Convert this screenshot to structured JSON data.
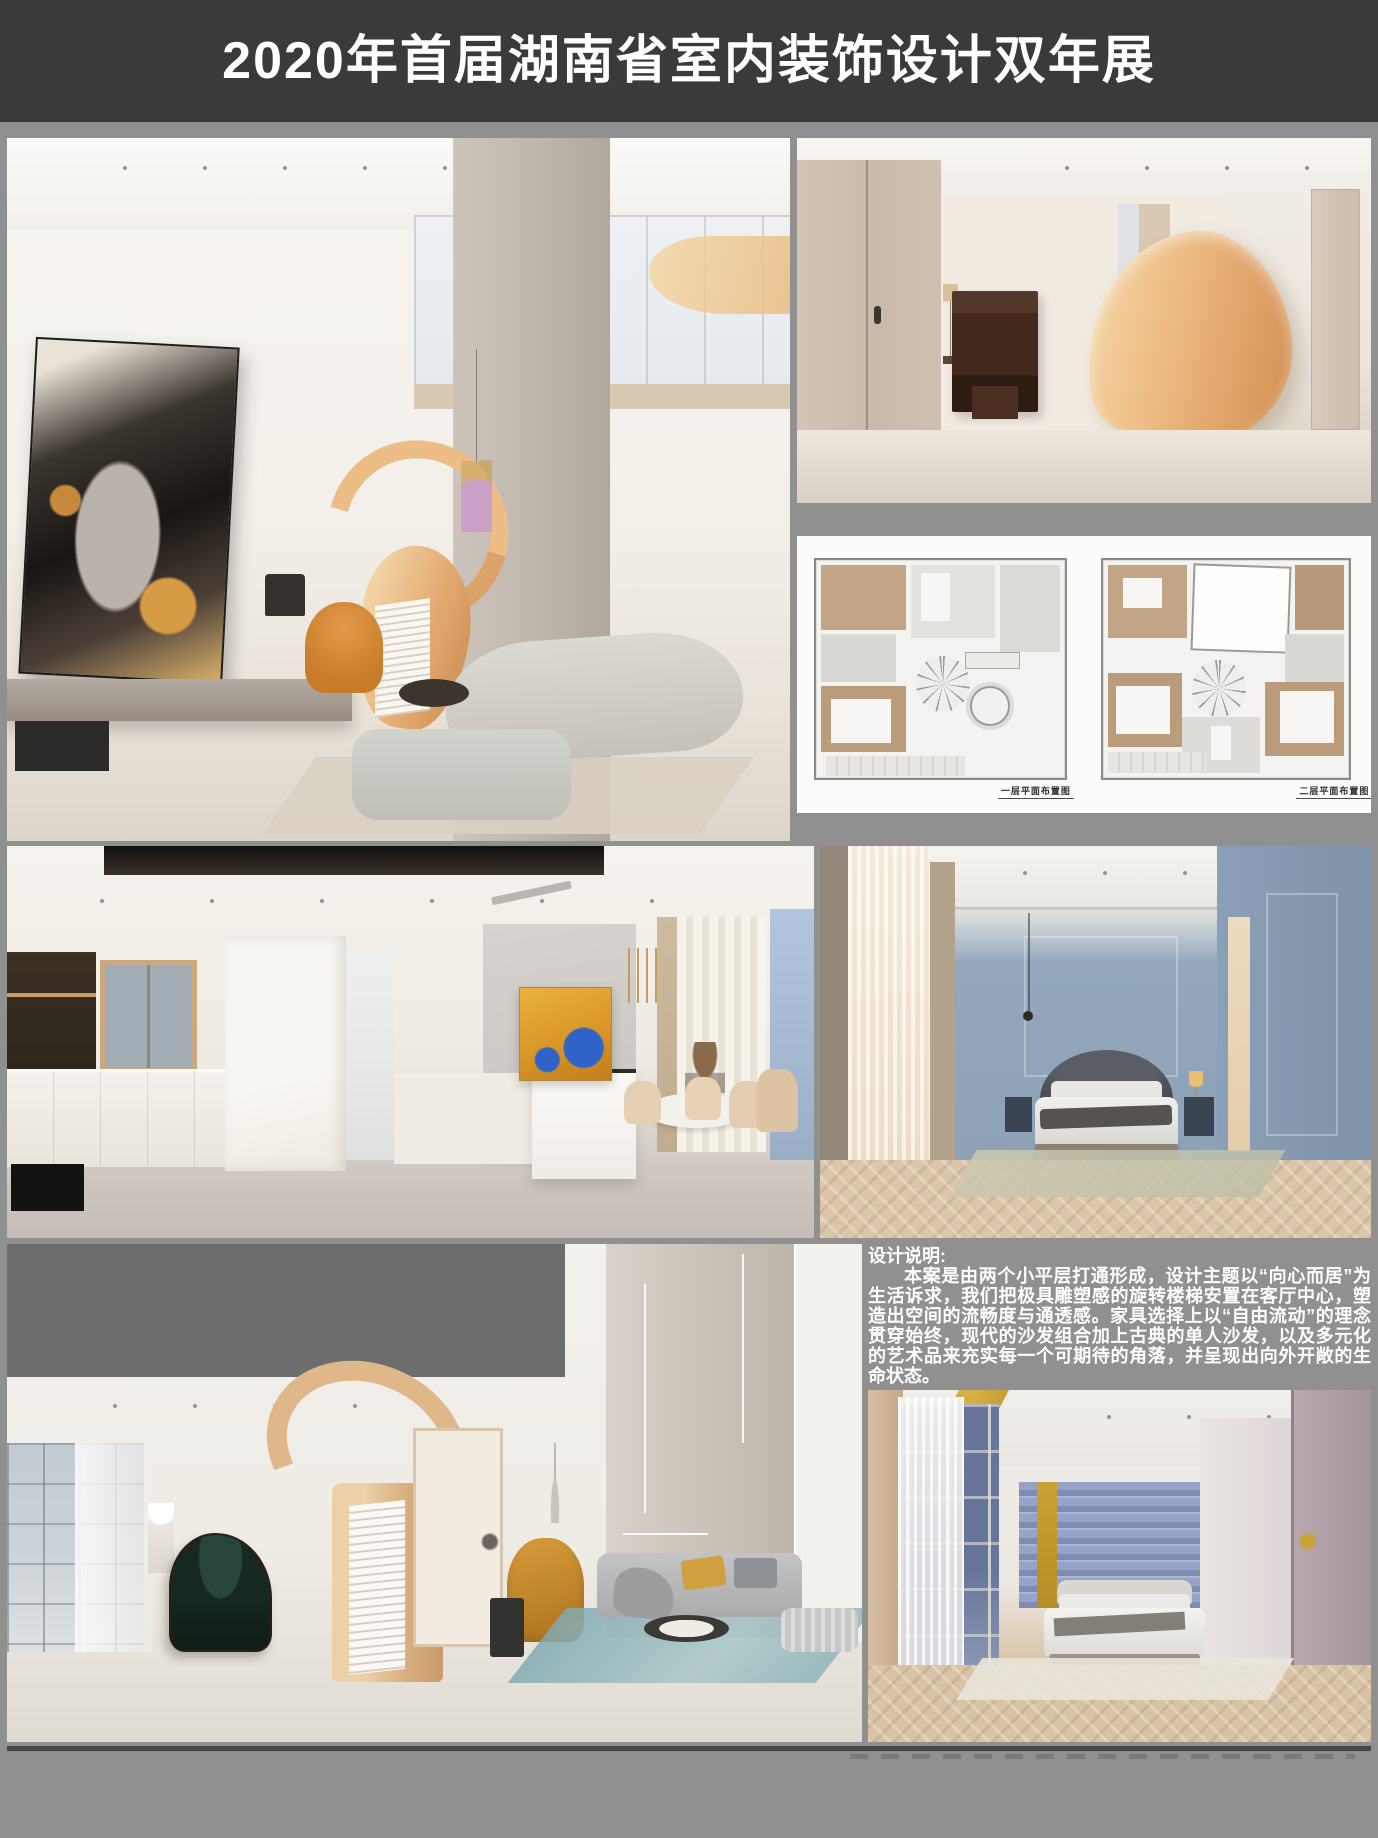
{
  "header": {
    "title": "2020年首届湖南省室内装饰设计双年展"
  },
  "description": {
    "heading": "设计说明:",
    "body": "本案是由两个小平层打通形成，设计主题以“向心而居”为生活诉求，我们把极具雕塑感的旋转楼梯安置在客厅中心，塑造出空间的流畅度与通透感。家具选择上以“自由流动”的理念贯穿始终，现代的沙发组合加上古典的单人沙发，以及多元化的艺术品来充实每一个可期待的角落，并呈现出向外开敞的生命状态。"
  },
  "floorplans": {
    "first_caption": "一层平面布置图",
    "second_caption": "二层平面布置图"
  },
  "colors": {
    "page_background": "#909090",
    "title_bar": "#3a3a3a",
    "title_text": "#ffffff",
    "description_text": "#ffffff",
    "shadow_line": "#474747",
    "accent_orange_staircase": "#e5b078",
    "accent_orange_armchair": "#d4882f",
    "blue_bedroom_wall": "#8da3ba",
    "night_bedroom_gold_band": "#c9a23a",
    "night_bedroom_stripe_wall": "#8c9cc4",
    "herringbone_floor": "#d9c3a5",
    "plan_wood_room": "#bb9c7a",
    "gray_mask_block": "#6d6d6d"
  }
}
